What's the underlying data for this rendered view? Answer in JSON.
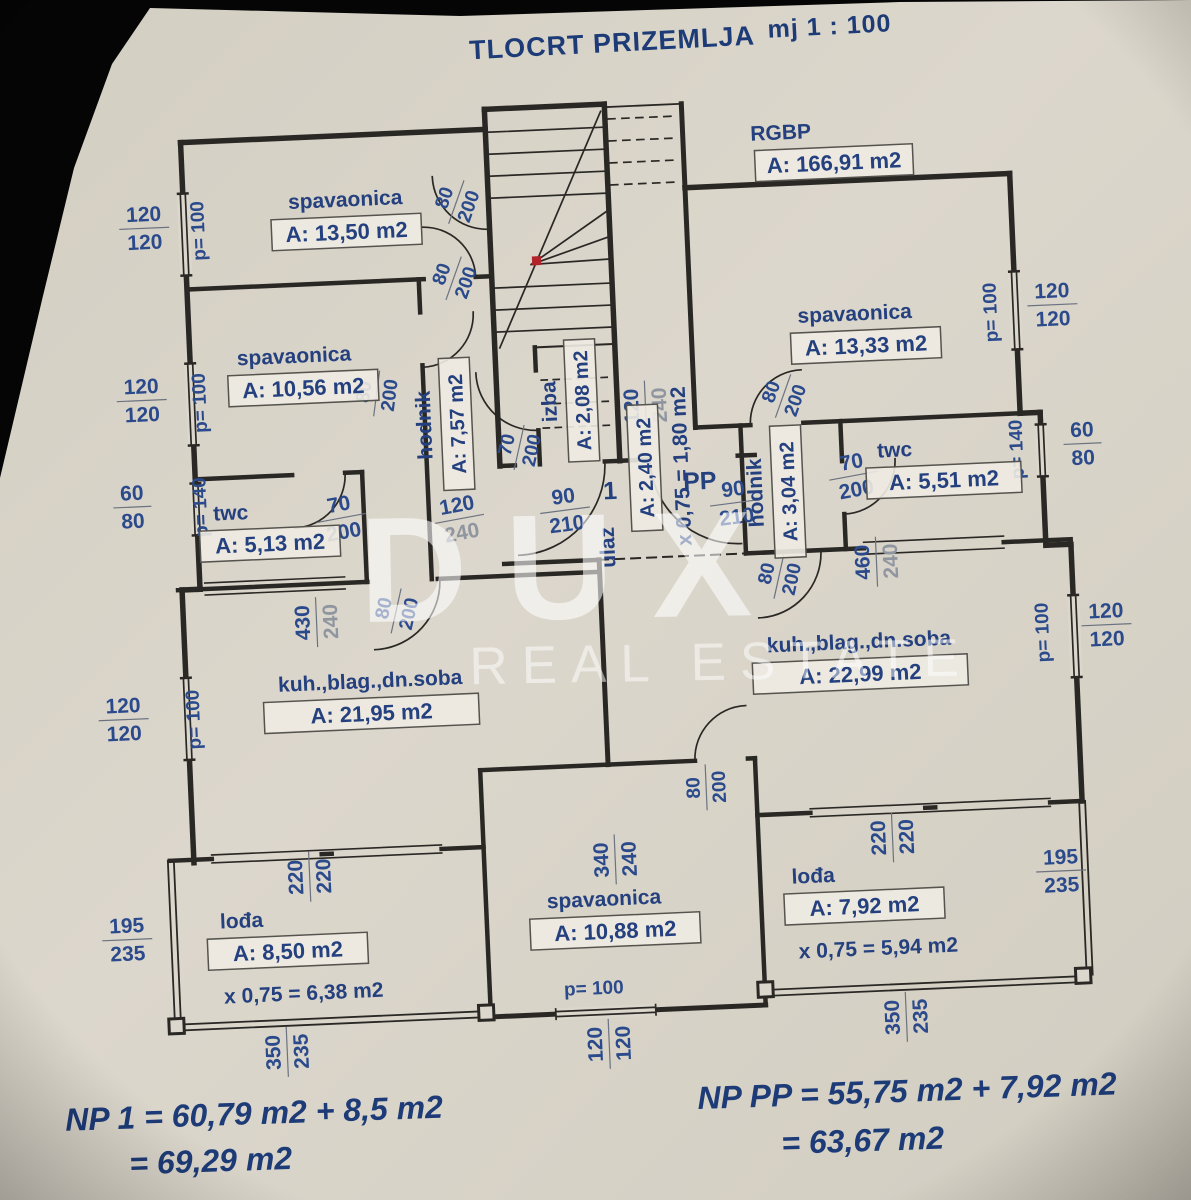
{
  "title": {
    "main": "TLOCRT PRIZEMLJA",
    "scale": "mj 1 : 100"
  },
  "watermark": {
    "brand": "DUX",
    "subtitle": "REAL ESTATE"
  },
  "summary": {
    "left": [
      "NP 1 = 60,79 m2 + 8,5 m2",
      "= 69,29 m2"
    ],
    "right": [
      "NP PP = 55,75 m2 + 7,92 m2",
      "= 63,67 m2"
    ]
  },
  "plan": {
    "room_labels": [
      {
        "name": "spavaonica",
        "area": "A: 13,50 m2",
        "x": 362,
        "y": 220,
        "w": 150
      },
      {
        "name": "spavaonica",
        "area": "A: 10,56 m2",
        "x": 312,
        "y": 374,
        "w": 150,
        "ndx": -8
      },
      {
        "name": "twc",
        "area": "A: 5,13 m2",
        "x": 272,
        "y": 528,
        "w": 140,
        "ndx": -38
      },
      {
        "name": "hodnik",
        "area": "A: 7,57 m2",
        "x": 462,
        "y": 418,
        "rot": -90,
        "w": 132
      },
      {
        "name": "izba",
        "area": "A: 2,08 m2",
        "x": 588,
        "y": 400,
        "rot": -90,
        "w": 122
      },
      {
        "name": "ulaz",
        "area": "A: 2,40 m2",
        "extra": "x 0,75 = 1,80 m2",
        "x": 648,
        "y": 470,
        "rot": -90,
        "w": 126,
        "ndx": -78,
        "ndy": -32,
        "edy": 28
      },
      {
        "name": "kuh.,blag.,dn.soba",
        "area": "A: 21,95 m2",
        "x": 366,
        "y": 702,
        "w": 215
      },
      {
        "name": "lođa",
        "area": "A: 8,50 m2",
        "extra": "x 0,75 = 6,38 m2",
        "x": 272,
        "y": 936,
        "w": 160,
        "ndx": -45,
        "edx": 14,
        "edy": 34
      },
      {
        "name": "RGBP",
        "area": "A: 166,91 m2",
        "x": 852,
        "y": 172,
        "w": 158,
        "ndx": -52
      },
      {
        "name": "spavaonica",
        "area": "A: 13,33 m2",
        "x": 876,
        "y": 356,
        "w": 150,
        "ndx": -10
      },
      {
        "name": "twc",
        "area": "A: 5,51 m2",
        "x": 948,
        "y": 494,
        "w": 155,
        "ndx": -48
      },
      {
        "name": "hodnik",
        "area": "A: 3,04 m2",
        "x": 790,
        "y": 500,
        "rot": -90,
        "w": 132
      },
      {
        "name": "kuh.,blag.,dn.soba",
        "area": "A: 22,99 m2",
        "x": 856,
        "y": 684,
        "w": 215
      },
      {
        "name": "spavaonica",
        "area": "A: 10,88 m2",
        "x": 600,
        "y": 930,
        "w": 170,
        "ndx": -10
      },
      {
        "name": "lođa",
        "area": "A: 7,92 m2",
        "extra": "x 0,75 = 5,94 m2",
        "x": 850,
        "y": 916,
        "w": 160,
        "ndx": -50,
        "edx": 12,
        "edy": 34
      }
    ],
    "dim_pairs": [
      {
        "a": "120",
        "b": "120",
        "x": 160,
        "y": 208
      },
      {
        "a": "120",
        "b": "120",
        "x": 150,
        "y": 380
      },
      {
        "a": "60",
        "b": "80",
        "x": 136,
        "y": 486
      },
      {
        "a": "120",
        "b": "120",
        "x": 118,
        "y": 698
      },
      {
        "a": "195",
        "b": "235",
        "x": 112,
        "y": 918
      },
      {
        "a": "350",
        "b": "235",
        "x": 266,
        "y": 1038,
        "rot": -90
      },
      {
        "a": "220",
        "b": "220",
        "x": 296,
        "y": 864,
        "rot": -90
      },
      {
        "a": "120",
        "b": "120",
        "x": 588,
        "y": 1044,
        "rot": -90
      },
      {
        "a": "340",
        "b": "240",
        "x": 602,
        "y": 860,
        "rot": -90
      },
      {
        "a": "350",
        "b": "235",
        "x": 886,
        "y": 1030,
        "rot": -90
      },
      {
        "a": "220",
        "b": "220",
        "x": 880,
        "y": 850,
        "rot": -90
      },
      {
        "a": "195",
        "b": "235",
        "x": 1048,
        "y": 890
      },
      {
        "a": "120",
        "b": "120",
        "x": 1104,
        "y": 646
      },
      {
        "a": "60",
        "b": "80",
        "x": 1088,
        "y": 464
      },
      {
        "a": "120",
        "b": "120",
        "x": 1064,
        "y": 324
      },
      {
        "a": "80",
        "b": "200",
        "x": 466,
        "y": 272,
        "rot": -68,
        "s": 0.92
      },
      {
        "a": "80",
        "b": "200",
        "x": 472,
        "y": 196,
        "rot": -68,
        "s": 0.92
      },
      {
        "a": "80",
        "b": "200",
        "x": 384,
        "y": 384,
        "rot": -80,
        "s": 0.92
      },
      {
        "a": "70",
        "b": "200",
        "x": 344,
        "y": 506,
        "rot": -8
      },
      {
        "a": "120",
        "b": "240",
        "x": 462,
        "y": 512,
        "rot": -8,
        "light": true
      },
      {
        "a": "70",
        "b": "200",
        "x": 524,
        "y": 444,
        "rot": -75,
        "s": 0.92
      },
      {
        "a": "90",
        "b": "210",
        "x": 568,
        "y": 508,
        "rot": -5
      },
      {
        "a": "90",
        "b": "210",
        "x": 738,
        "y": 508,
        "rot": -5
      },
      {
        "a": "120",
        "b": "240",
        "x": 652,
        "y": 408,
        "rot": -90,
        "light": true
      },
      {
        "a": "430",
        "b": "240",
        "x": 314,
        "y": 610,
        "rot": -90,
        "light": true
      },
      {
        "a": "80",
        "b": "200",
        "x": 394,
        "y": 602,
        "rot": -75,
        "s": 0.92
      },
      {
        "a": "80",
        "b": "200",
        "x": 778,
        "y": 584,
        "rot": -75,
        "s": 0.92
      },
      {
        "a": "460",
        "b": "240",
        "x": 876,
        "y": 574,
        "rot": -90,
        "light": true
      },
      {
        "a": "80",
        "b": "200",
        "x": 790,
        "y": 404,
        "rot": -68,
        "s": 0.92
      },
      {
        "a": "70",
        "b": "200",
        "x": 858,
        "y": 486,
        "rot": -8
      },
      {
        "a": "80",
        "b": "200",
        "x": 696,
        "y": 792,
        "rot": -90,
        "s": 0.92
      }
    ],
    "dim_singles": [
      {
        "t": "p= 100",
        "x": 220,
        "y": 214,
        "rot": -90
      },
      {
        "t": "p= 100",
        "x": 214,
        "y": 386,
        "rot": -90
      },
      {
        "t": "p= 140",
        "x": 210,
        "y": 490,
        "rot": -90
      },
      {
        "t": "p= 100",
        "x": 194,
        "y": 702,
        "rot": -90
      },
      {
        "t": "p= 100",
        "x": 576,
        "y": 994
      },
      {
        "t": "p= 100",
        "x": 1008,
        "y": 330,
        "rot": -90
      },
      {
        "t": "p= 140",
        "x": 1028,
        "y": 468,
        "rot": -90
      },
      {
        "t": "p= 100",
        "x": 1046,
        "y": 652,
        "rot": -90
      },
      {
        "t": "1",
        "x": 614,
        "y": 500,
        "big": true
      },
      {
        "t": "PP",
        "x": 704,
        "y": 494,
        "big": true
      }
    ]
  }
}
